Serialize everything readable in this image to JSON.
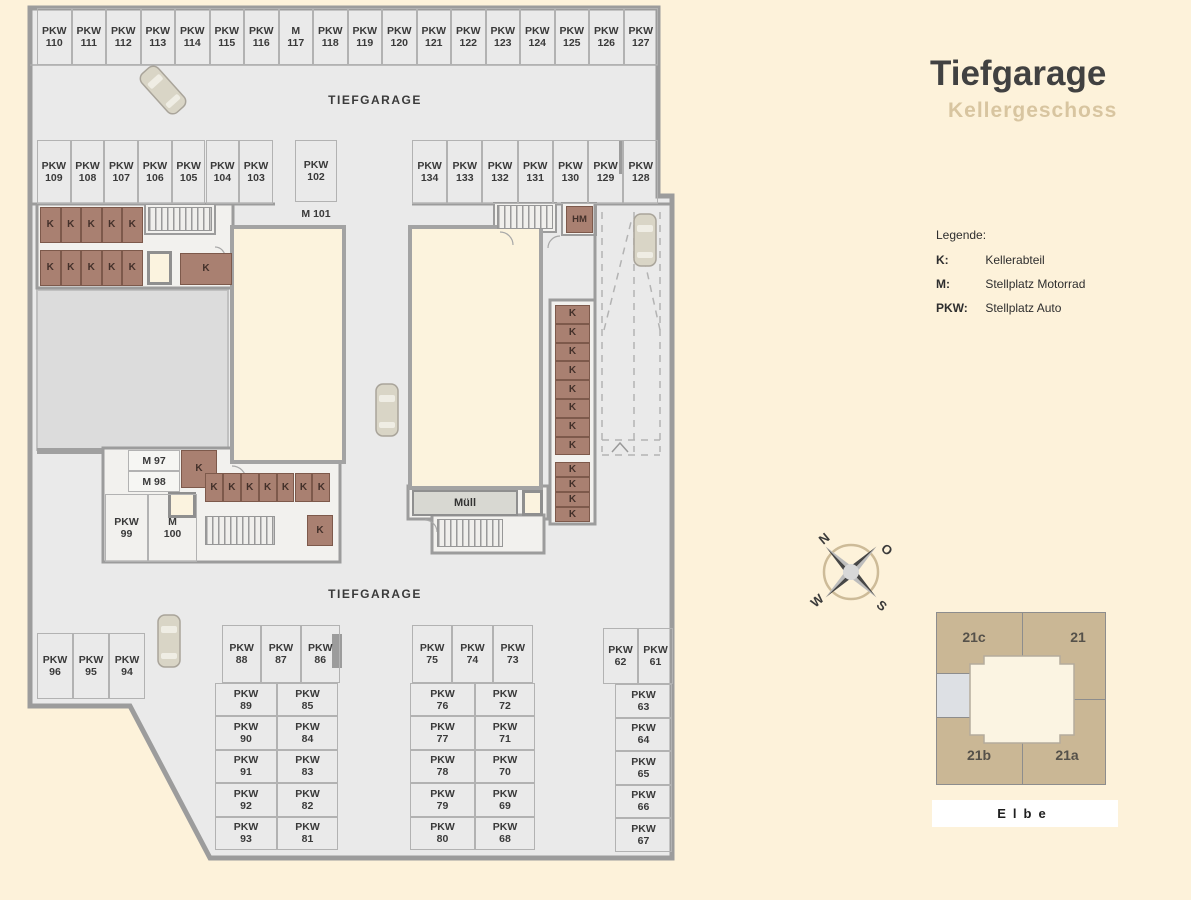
{
  "title": {
    "main": "Tiefgarage",
    "sub": "Kellergeschoss"
  },
  "legend": {
    "heading": "Legende:",
    "items": [
      {
        "key": "K:",
        "value": "Kellerabteil"
      },
      {
        "key": "M:",
        "value": "Stellplatz Motorrad"
      },
      {
        "key": "PKW:",
        "value": "Stellplatz Auto"
      }
    ]
  },
  "compass": {
    "n": "N",
    "o": "O",
    "w": "W",
    "s": "S"
  },
  "sitemap": {
    "buildings": [
      "21c",
      "21",
      "21b",
      "21a"
    ],
    "river": "Elbe"
  },
  "colors": {
    "background": "#fdf2da",
    "floor": "#eaeaea",
    "wall": "#9c9c9c",
    "storage": "#a98071",
    "building": "#fcf3dd",
    "site_building": "#cab795",
    "subtitle": "#d8c5a0"
  },
  "plan": {
    "texts": {
      "garage_top": "TIEFGARAGE",
      "garage_bottom": "TIEFGARAGE"
    },
    "spot_groups": [
      {
        "kind": "pkw",
        "dir": "h",
        "x": 37,
        "y": 8,
        "cw": 34.5,
        "ch": 57,
        "cells": [
          "PKW 110",
          "PKW 111",
          "PKW 112",
          "PKW 113",
          "PKW 114",
          "PKW 115",
          "PKW 116",
          "M 117",
          "PKW 118",
          "PKW 119",
          "PKW 120",
          "PKW 121",
          "PKW 122",
          "PKW 123",
          "PKW 124",
          "PKW 125",
          "PKW 126",
          "PKW 127"
        ]
      },
      {
        "kind": "pkw",
        "dir": "h",
        "x": 37,
        "y": 140,
        "cw": 33.7,
        "ch": 64,
        "cells": [
          "PKW 109",
          "PKW 108",
          "PKW 107",
          "PKW 106",
          "PKW 105",
          "PKW 104",
          "PKW 103"
        ]
      },
      {
        "kind": "pkw",
        "dir": "h",
        "x": 295,
        "y": 140,
        "cw": 42,
        "ch": 62,
        "cells": [
          "PKW 102"
        ]
      },
      {
        "kind": "pkw",
        "dir": "h",
        "x": 412,
        "y": 140,
        "cw": 35.2,
        "ch": 64,
        "cells": [
          "PKW 134",
          "PKW 133",
          "PKW 132",
          "PKW 131",
          "PKW 130",
          "PKW 129",
          "PKW 128"
        ]
      },
      {
        "kind": "label",
        "dir": "h",
        "x": 290,
        "y": 206,
        "cw": 52,
        "ch": 16,
        "cells": [
          "M 101"
        ]
      },
      {
        "kind": "k",
        "dir": "h",
        "x": 40,
        "y": 207,
        "cw": 20.5,
        "ch": 36,
        "cells": [
          "K",
          "K",
          "K",
          "K",
          "K"
        ]
      },
      {
        "kind": "k",
        "dir": "h",
        "x": 40,
        "y": 250,
        "cw": 20.5,
        "ch": 36,
        "cells": [
          "K",
          "K",
          "K",
          "K",
          "K"
        ]
      },
      {
        "kind": "k",
        "dir": "h",
        "x": 180,
        "y": 253,
        "cw": 52,
        "ch": 32,
        "cells": [
          "K"
        ]
      },
      {
        "kind": "mcell",
        "dir": "h",
        "x": 128,
        "y": 450,
        "cw": 52,
        "ch": 21,
        "cells": [
          "M 97"
        ]
      },
      {
        "kind": "mcell",
        "dir": "h",
        "x": 128,
        "y": 471,
        "cw": 52,
        "ch": 21,
        "cells": [
          "M 98"
        ]
      },
      {
        "kind": "k",
        "dir": "h",
        "x": 181,
        "y": 450,
        "cw": 36,
        "ch": 38,
        "cells": [
          "K"
        ]
      },
      {
        "kind": "k",
        "dir": "h",
        "x": 205,
        "y": 473,
        "cw": 17.9,
        "ch": 29,
        "cells": [
          "K",
          "K",
          "K",
          "K",
          "K",
          "K",
          "K"
        ]
      },
      {
        "kind": "k",
        "dir": "h",
        "x": 307,
        "y": 515,
        "cw": 26,
        "ch": 31,
        "cells": [
          "K"
        ]
      },
      {
        "kind": "pkw",
        "dir": "h",
        "x": 105,
        "y": 494,
        "cw": 43,
        "ch": 68,
        "cells": [
          "PKW 99"
        ]
      },
      {
        "kind": "pkw",
        "dir": "h",
        "x": 148,
        "y": 494,
        "cw": 49,
        "ch": 68,
        "cells": [
          "M 100"
        ]
      },
      {
        "kind": "k",
        "dir": "v",
        "x": 555,
        "y": 305,
        "cw": 35,
        "ch": 18.8,
        "cells": [
          "K",
          "K",
          "K",
          "K",
          "K",
          "K",
          "K",
          "K"
        ]
      },
      {
        "kind": "k",
        "dir": "v",
        "x": 555,
        "y": 462,
        "cw": 35,
        "ch": 15,
        "cells": [
          "K",
          "K",
          "K",
          "K"
        ]
      },
      {
        "kind": "hm",
        "dir": "h",
        "x": 566,
        "y": 206,
        "cw": 27,
        "ch": 27,
        "cells": [
          "HM"
        ]
      },
      {
        "kind": "muell",
        "dir": "h",
        "x": 412,
        "y": 490,
        "cw": 106,
        "ch": 26,
        "cells": [
          "Müll"
        ]
      },
      {
        "kind": "pkw",
        "dir": "h",
        "x": 37,
        "y": 633,
        "cw": 36,
        "ch": 66,
        "cells": [
          "PKW 96",
          "PKW 95",
          "PKW 94"
        ]
      },
      {
        "kind": "pkw",
        "dir": "h",
        "x": 222,
        "y": 625,
        "cw": 39.3,
        "ch": 58,
        "cells": [
          "PKW 88",
          "PKW 87",
          "PKW 86"
        ]
      },
      {
        "kind": "pkw",
        "dir": "v",
        "x": 215,
        "y": 683,
        "cw": 62,
        "ch": 33.4,
        "cells": [
          "PKW 89",
          "PKW 90",
          "PKW 91",
          "PKW 92",
          "PKW 93"
        ]
      },
      {
        "kind": "pkw",
        "dir": "v",
        "x": 277,
        "y": 683,
        "cw": 61,
        "ch": 33.4,
        "cells": [
          "PKW 85",
          "PKW 84",
          "PKW 83",
          "PKW 82",
          "PKW 81"
        ]
      },
      {
        "kind": "pkw",
        "dir": "h",
        "x": 412,
        "y": 625,
        "cw": 40.3,
        "ch": 58,
        "cells": [
          "PKW 75",
          "PKW 74",
          "PKW 73"
        ]
      },
      {
        "kind": "pkw",
        "dir": "v",
        "x": 410,
        "y": 683,
        "cw": 65,
        "ch": 33.4,
        "cells": [
          "PKW 76",
          "PKW 77",
          "PKW 78",
          "PKW 79",
          "PKW 80"
        ]
      },
      {
        "kind": "pkw",
        "dir": "v",
        "x": 475,
        "y": 683,
        "cw": 60,
        "ch": 33.4,
        "cells": [
          "PKW 72",
          "PKW 71",
          "PKW 70",
          "PKW 69",
          "PKW 68"
        ]
      },
      {
        "kind": "pkw",
        "dir": "h",
        "x": 603,
        "y": 628,
        "cw": 35,
        "ch": 56,
        "cells": [
          "PKW 62",
          "PKW 61"
        ]
      },
      {
        "kind": "pkw",
        "dir": "v",
        "x": 615,
        "y": 684,
        "cw": 57,
        "ch": 33.5,
        "cells": [
          "PKW 63",
          "PKW 64",
          "PKW 65",
          "PKW 66",
          "PKW 67"
        ]
      }
    ]
  }
}
